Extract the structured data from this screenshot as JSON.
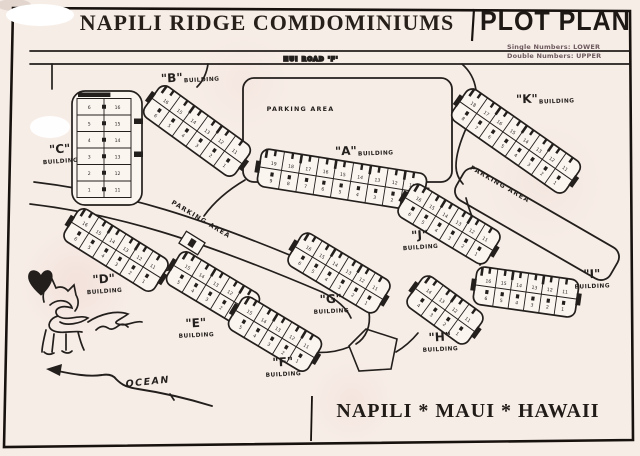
{
  "strings": {
    "title": "NAPILI RIDGE COMDOMINIUMS",
    "plan_label": "PLOT PLAN",
    "legend_line1": "Single Numbers: LOWER",
    "legend_line2": "Double Numbers: UPPER",
    "road_label": "HUI ROAD 'F'",
    "parking_label": "PARKING AREA",
    "building_word": "BUILDING",
    "location": "NAPILI * MAUI * HAWAII",
    "ocean_label": "OCEAN"
  },
  "colors": {
    "paper": "#f7ede7",
    "ink": "#231f1c",
    "building_fill": "#fbf5f0"
  },
  "road": {
    "label_x": 311,
    "label_y": 61
  },
  "parking_areas": [
    {
      "name": "parking-area-top",
      "cx": 347.5,
      "cy": 130,
      "w": 209,
      "h": 104,
      "rot": 0,
      "label_dx": -47,
      "label_dy": -19
    },
    {
      "name": "parking-area-east",
      "cx": 537,
      "cy": 224,
      "w": 178,
      "h": 36,
      "rot": 30,
      "label_dx": -52,
      "label_dy": -14
    },
    {
      "name": "parking-area-central",
      "cx": 200,
      "cy": 221,
      "w": 0,
      "h": 0,
      "rot": 31,
      "label_dx": 0,
      "label_dy": 0
    }
  ],
  "buildings": [
    {
      "letter": "A",
      "letter_display": "\"A\"",
      "cx": 342,
      "cy": 180,
      "rot": 9,
      "units": 9,
      "uw": 17.5,
      "upper": [
        "19",
        "18",
        "17",
        "16",
        "15",
        "14",
        "13",
        "12",
        "11"
      ],
      "lower": [
        "9",
        "8",
        "7",
        "6",
        "5",
        "4",
        "3",
        "2",
        "1"
      ],
      "label": {
        "x": 346,
        "y": 155,
        "rot": -2,
        "layout": "inline"
      }
    },
    {
      "letter": "B",
      "letter_display": "\"B\"",
      "cx": 197,
      "cy": 131,
      "rot": 36,
      "units": 6,
      "uw": 17,
      "upper": [
        "16",
        "15",
        "14",
        "13",
        "12",
        "11"
      ],
      "lower": [
        "6",
        "5",
        "4",
        "3",
        "2",
        "1"
      ],
      "label": {
        "x": 172,
        "y": 82,
        "rot": -3,
        "layout": "inline"
      }
    },
    {
      "letter": "C",
      "letter_display": "\"C\"",
      "cx": 104,
      "cy": 148,
      "vertical": true,
      "cols": 2,
      "rows": 6,
      "cw": 27,
      "rh": 16.5,
      "left": [
        "6",
        "5",
        "4",
        "3",
        "2",
        "1"
      ],
      "right": [
        "16",
        "15",
        "14",
        "13",
        "12",
        "11"
      ],
      "label": {
        "x": 60,
        "y": 153,
        "rot": -4,
        "layout": "below"
      }
    },
    {
      "letter": "D",
      "letter_display": "\"D\"",
      "cx": 116,
      "cy": 250,
      "rot": 32,
      "units": 6,
      "uw": 16,
      "upper": [
        "16",
        "15",
        "14",
        "13",
        "12",
        "11"
      ],
      "lower": [
        "6",
        "5",
        "4",
        "3",
        "2",
        "1"
      ],
      "label": {
        "x": 104,
        "y": 283,
        "rot": -4,
        "layout": "below"
      }
    },
    {
      "letter": "E",
      "letter_display": "\"E\"",
      "cx": 213,
      "cy": 289,
      "rot": 31,
      "units": 5,
      "uw": 16.5,
      "upper": [
        "15",
        "14",
        "13",
        "12",
        "11"
      ],
      "lower": [
        "5",
        "4",
        "3",
        "2",
        "1"
      ],
      "label": {
        "x": 196,
        "y": 327,
        "rot": -3,
        "layout": "below"
      }
    },
    {
      "letter": "F",
      "letter_display": "\"F\"",
      "cx": 275,
      "cy": 334,
      "rot": 31,
      "units": 5,
      "uw": 16.5,
      "upper": [
        "15",
        "14",
        "13",
        "12",
        "11"
      ],
      "lower": [
        "5",
        "4",
        "3",
        "2",
        "1"
      ],
      "label": {
        "x": 283,
        "y": 366,
        "rot": -3,
        "layout": "below"
      }
    },
    {
      "letter": "G",
      "letter_display": "\"G\"",
      "cx": 339,
      "cy": 273,
      "rot": 31,
      "units": 6,
      "uw": 15.5,
      "upper": [
        "16",
        "15",
        "14",
        "13",
        "12",
        "11"
      ],
      "lower": [
        "6",
        "5",
        "4",
        "3",
        "2",
        "1"
      ],
      "label": {
        "x": 331,
        "y": 303,
        "rot": -3,
        "layout": "below"
      }
    },
    {
      "letter": "H",
      "letter_display": "\"H\"",
      "cx": 445,
      "cy": 310,
      "rot": 36,
      "units": 4,
      "uw": 16,
      "upper": [
        "14",
        "13",
        "12",
        "11"
      ],
      "lower": [
        "4",
        "3",
        "2",
        "1"
      ],
      "label": {
        "x": 440,
        "y": 341,
        "rot": -3,
        "layout": "below"
      }
    },
    {
      "letter": "I",
      "letter_display": "\"I\"",
      "cx": 526,
      "cy": 292,
      "rot": 8,
      "units": 6,
      "uw": 15.5,
      "upper": [
        "16",
        "15",
        "14",
        "13",
        "12",
        "11"
      ],
      "lower": [
        "6",
        "5",
        "4",
        "3",
        "2",
        "1"
      ],
      "label": {
        "x": 592,
        "y": 278,
        "rot": -2,
        "layout": "below"
      }
    },
    {
      "letter": "J",
      "letter_display": "\"J\"",
      "cx": 449,
      "cy": 224,
      "rot": 31,
      "units": 6,
      "uw": 15.5,
      "upper": [
        "16",
        "15",
        "14",
        "13",
        "12",
        "11"
      ],
      "lower": [
        "6",
        "5",
        "4",
        "3",
        "2",
        "1"
      ],
      "label": {
        "x": 420,
        "y": 239,
        "rot": -4,
        "layout": "below"
      }
    },
    {
      "letter": "K",
      "letter_display": "\"K\"",
      "cx": 516,
      "cy": 141,
      "rot": 35,
      "units": 8,
      "uw": 16,
      "upper": [
        "18",
        "17",
        "16",
        "15",
        "14",
        "13",
        "12",
        "11"
      ],
      "lower": [
        "8",
        "7",
        "6",
        "5",
        "4",
        "3",
        "2",
        "1"
      ],
      "label": {
        "x": 527,
        "y": 103,
        "rot": -2,
        "layout": "inline"
      }
    }
  ]
}
